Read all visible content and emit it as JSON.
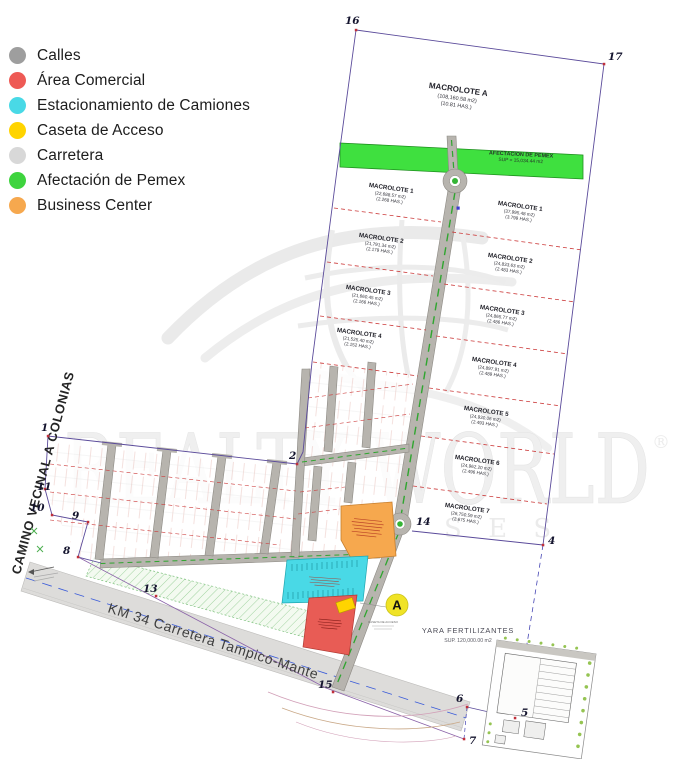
{
  "legend": {
    "items": [
      {
        "id": "calles",
        "label": "Calles",
        "color": "#9e9e9e"
      },
      {
        "id": "area-comercial",
        "label": "Área Comercial",
        "color": "#ee5a55"
      },
      {
        "id": "estacionamiento-camiones",
        "label": "Estacionamiento de Camiones",
        "color": "#49d9e6"
      },
      {
        "id": "caseta-acceso",
        "label": "Caseta de Acceso",
        "color": "#ffd400"
      },
      {
        "id": "carretera",
        "label": "Carretera",
        "color": "#d8d8d8"
      },
      {
        "id": "afectacion-pemex",
        "label": "Afectación de Pemex",
        "color": "#3ed43e"
      },
      {
        "id": "business-center",
        "label": "Business Center",
        "color": "#f6a84e"
      }
    ]
  },
  "watermark": {
    "text": "REALTY WORLD",
    "registered": "®",
    "tagline": "S E S"
  },
  "plan": {
    "macrolote_a": {
      "name": "MACROLOTE A",
      "area": "(108,160.58 m2)",
      "has": "(10.81 HAS.)"
    },
    "pemex_strip": {
      "line1": "AFECTACION DE PEMEX",
      "line2": "SUP = 15,034.44 m2"
    },
    "west_macrolotes": [
      {
        "name": "MACROLOTE 1",
        "area": "(22,688.57 m2)",
        "has": "(2.268 HAS.)"
      },
      {
        "name": "MACROLOTE 2",
        "area": "(21,791.34 m2)",
        "has": "(2.179 HAS.)"
      },
      {
        "name": "MACROLOTE 3",
        "area": "(21,660.45 m2)",
        "has": "(2.166 HAS.)"
      },
      {
        "name": "MACROLOTE 4",
        "area": "(21,525.40 m2)",
        "has": "(2.152 HAS.)"
      }
    ],
    "east_macrolotes": [
      {
        "name": "MACROLOTE 1",
        "area": "(37,995.48 m2)",
        "has": "(3.799 HAS.)"
      },
      {
        "name": "MACROLOTE 2",
        "area": "(24,833.63 m2)",
        "has": "(2.483 HAS.)"
      },
      {
        "name": "MACROLOTE 3",
        "area": "(24,865.77 m2)",
        "has": "(2.486 HAS.)"
      },
      {
        "name": "MACROLOTE 4",
        "area": "(24,897.91 m2)",
        "has": "(2.489 HAS.)"
      },
      {
        "name": "MACROLOTE 5",
        "area": "(24,930.06 m2)",
        "has": "(2.493 HAS.)"
      },
      {
        "name": "MACROLOTE 6",
        "area": "(24,962.20 m2)",
        "has": "(2.496 HAS.)"
      },
      {
        "name": "MACROLOTE 7",
        "area": "(26,750.59 m2)",
        "has": "(2.675 HAS.)"
      }
    ],
    "yara": {
      "line1": "YARA FERTILIZANTES",
      "line2": "SUP. 120,000.00 m2"
    },
    "roads": {
      "camino_vecinal": "CAMINO VECINAL A COLONIAS",
      "carretera": "KM 34 Carretera Tampico-Mante"
    },
    "access": {
      "marker": "A",
      "caption": "CASETA DE ACCESO"
    },
    "points": {
      "p1": "1",
      "p2": "2",
      "p4": "4",
      "p5": "5",
      "p6": "6",
      "p7": "7",
      "p8": "8",
      "p9": "9",
      "p10": "10",
      "p11": "11",
      "p13": "13",
      "p14": "14",
      "p15": "15",
      "p16": "16",
      "p17": "17"
    }
  }
}
